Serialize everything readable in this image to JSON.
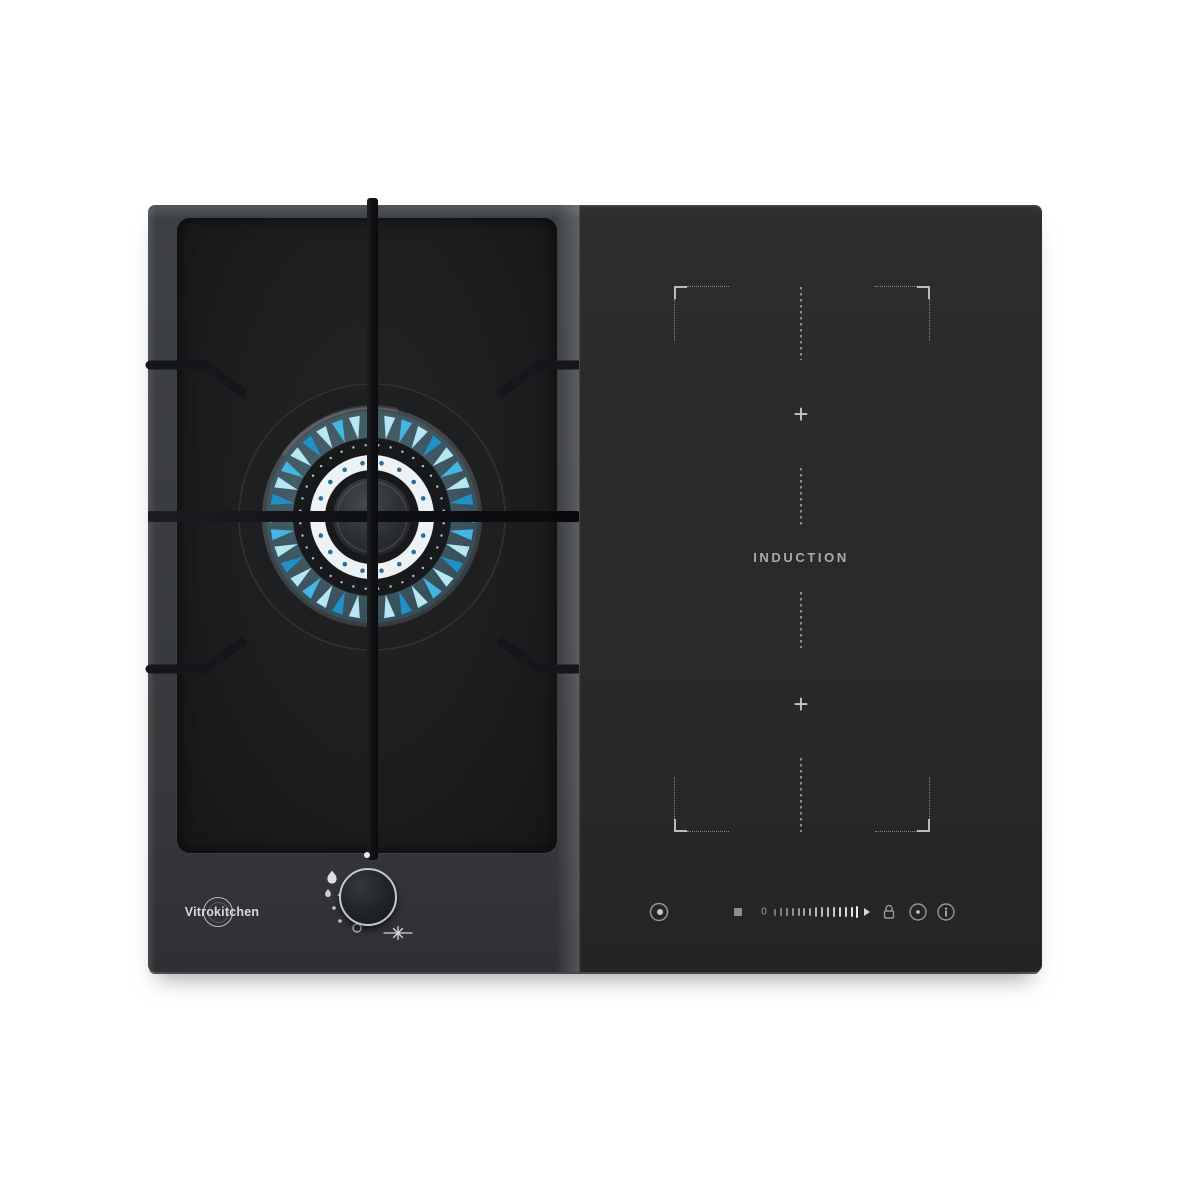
{
  "product": {
    "brand": "Vitrokitchen",
    "type_label": "INDUCTION",
    "plus_top": "+",
    "plus_bottom": "+",
    "slider_zero": "0"
  },
  "colors": {
    "background": "#ffffff",
    "frame_gray": "#3b3e41",
    "gas_glass": "#1a1c1e",
    "induction_glass": "#2a2c2e",
    "marking_gray": "#9da1a4",
    "flame_bright": "#bdeefb",
    "flame_mid": "#45bce9",
    "flame_deep": "#1e95cf",
    "crown_white": "#eef2f4",
    "crown_dot_blue": "#2b6d9c",
    "spark_dot_white": "#cfe8f4"
  },
  "burner": {
    "flame_count": 36,
    "spark_dot_count": 36,
    "crown_dot_count": 18
  },
  "slider": {
    "bar_count": 15
  },
  "icons": {
    "touch_controls": [
      "power-icon",
      "stop-square-icon",
      "power-slider",
      "slider-arrow-icon",
      "lock-icon",
      "timer-dot-icon",
      "info-icon"
    ],
    "knob_markings": [
      "off-position-dot",
      "flame-large-icon",
      "flame-small-icon",
      "position-dot",
      "position-dot",
      "simmer-circle-icon",
      "ignition-spark-icon"
    ]
  }
}
